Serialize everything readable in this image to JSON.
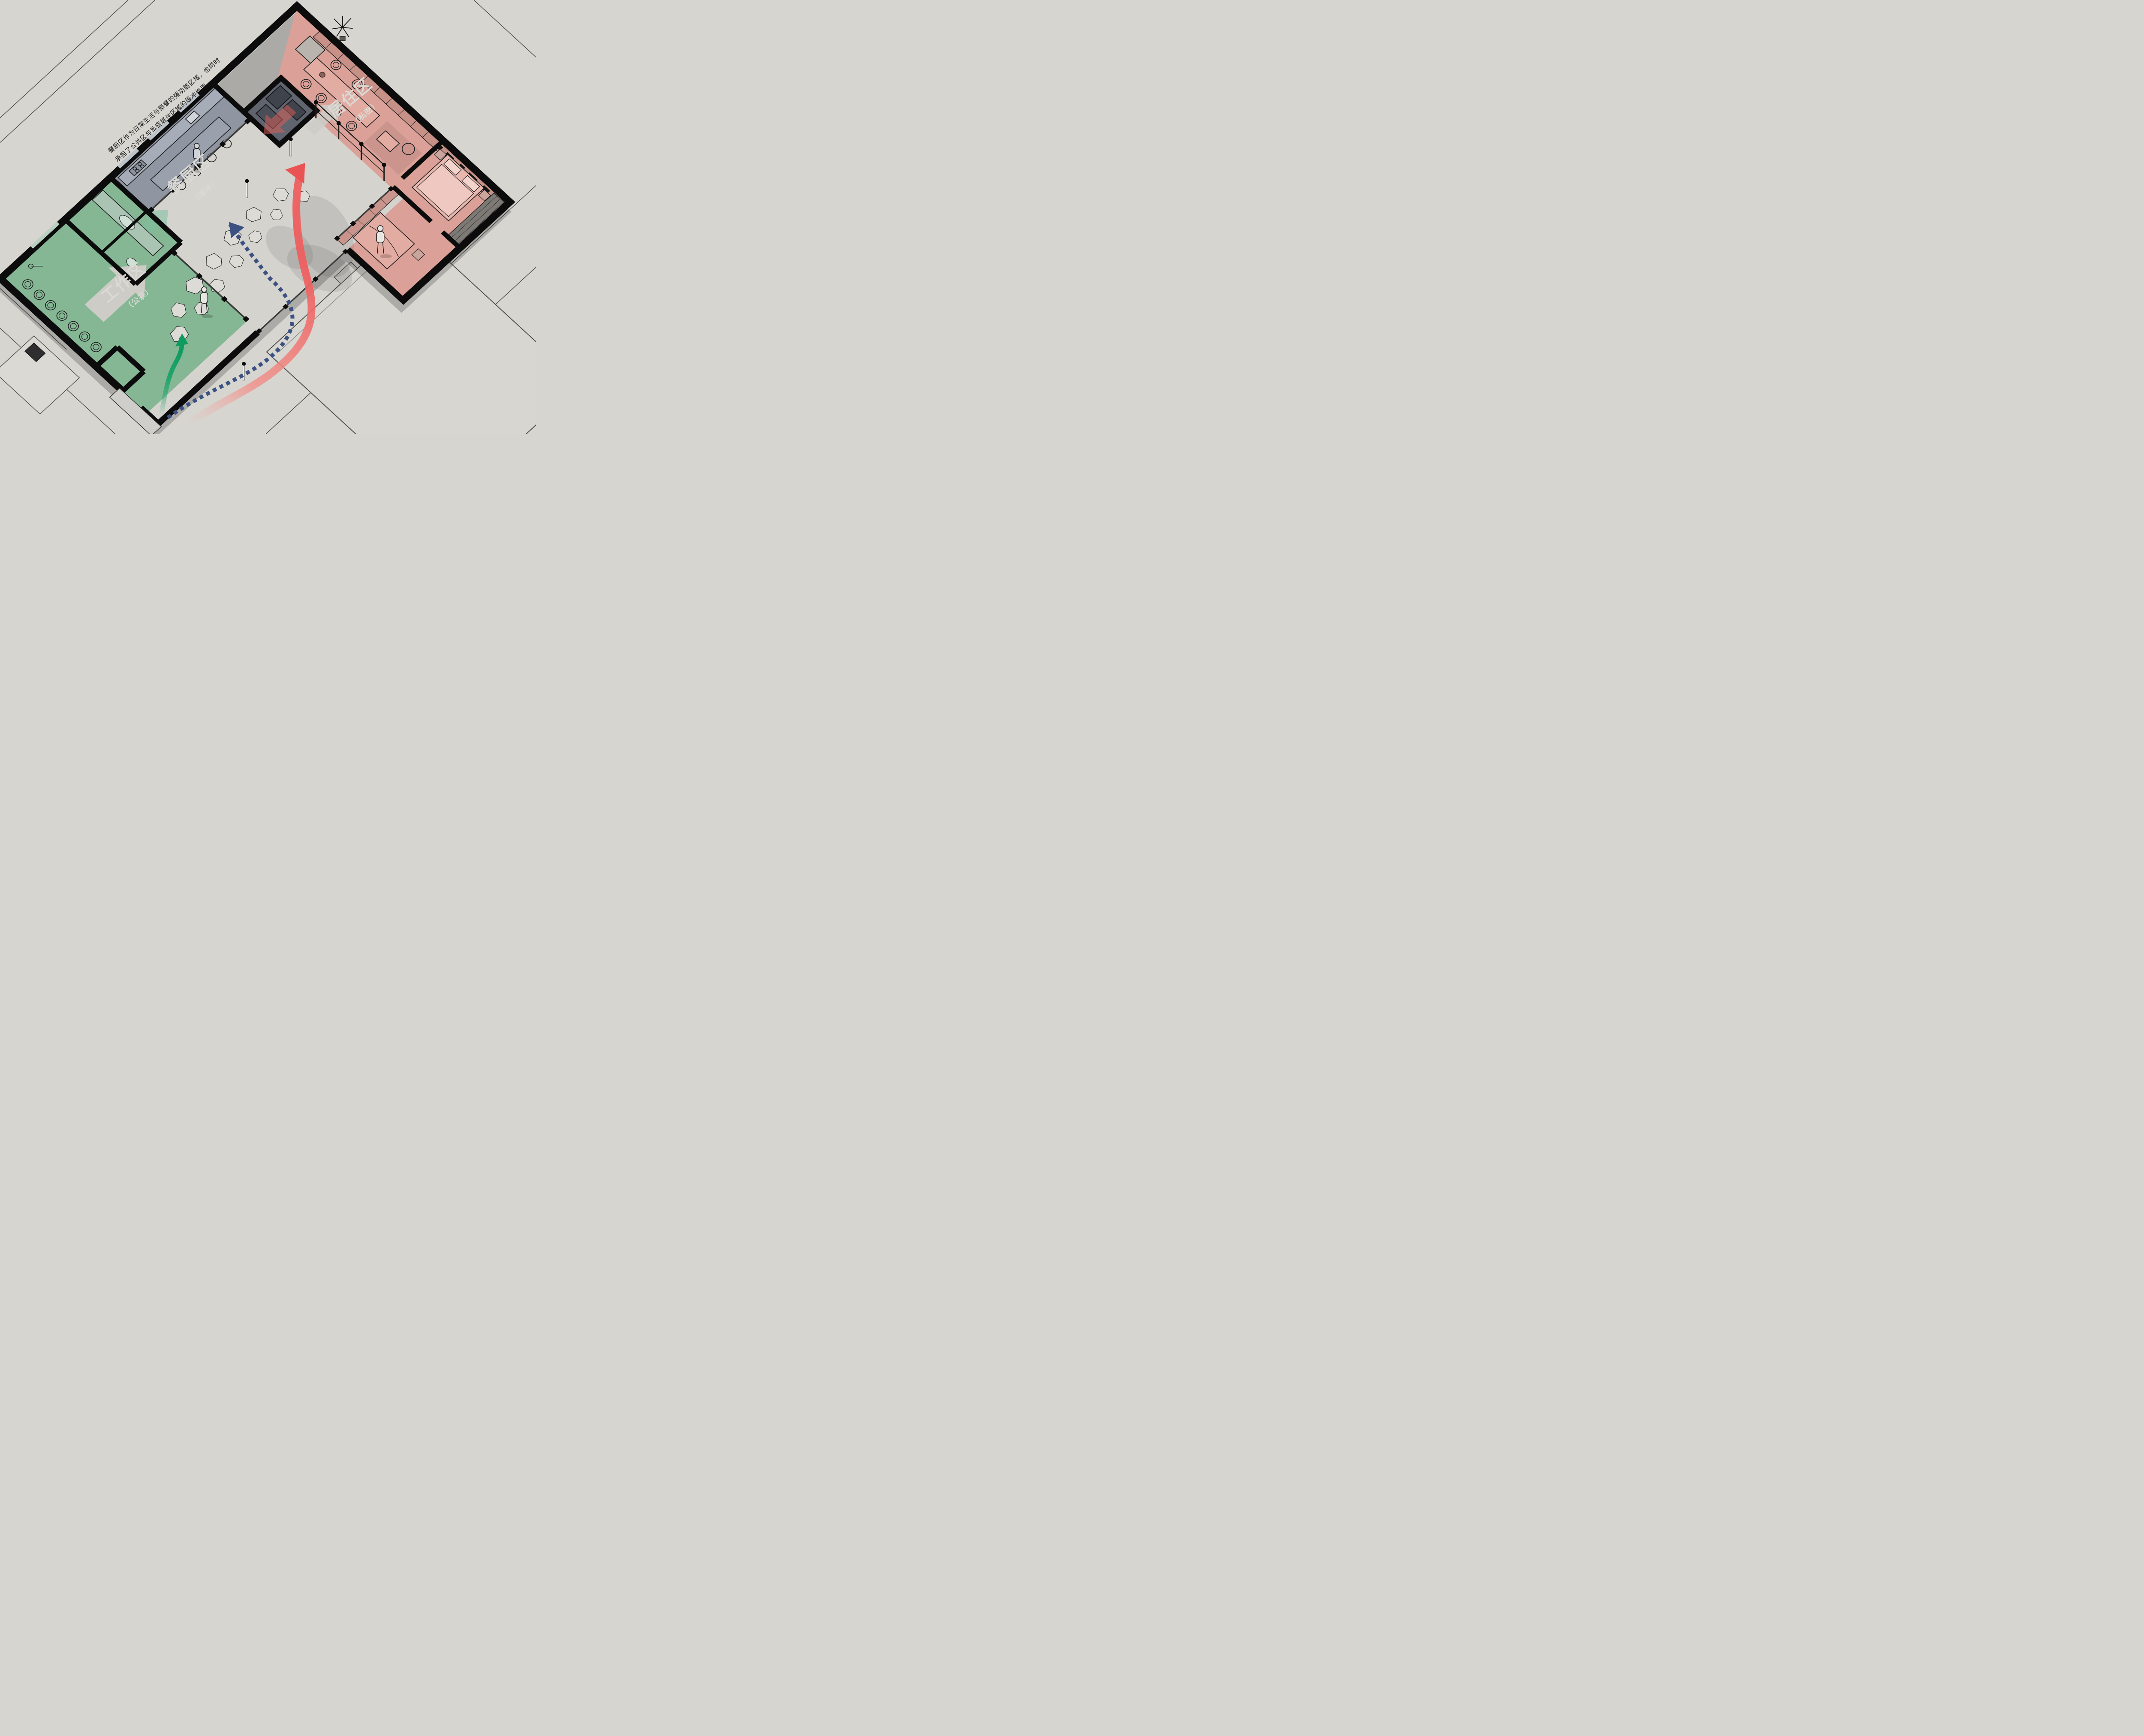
{
  "diagram": {
    "type": "axonometric-floor-plan",
    "annotation": {
      "line1": "餐厨区作为日常生活与聚餐的强功能区域，也同时",
      "line2": "承担了公共区与私密居住区域的缓冲作用。"
    },
    "zones": {
      "dining": {
        "label": "餐厨区",
        "sublabel": "（缓冲）",
        "color": "#8f95a1"
      },
      "living": {
        "label": "居住区",
        "sublabel": "（私密）",
        "color": "#dba198"
      },
      "work": {
        "label": "工作区",
        "sublabel": "（公共）",
        "color": "#85b795"
      }
    },
    "flows": [
      {
        "name": "living-route",
        "style": "solid-ribbon",
        "color": "#ee5f5f",
        "target": "居住区"
      },
      {
        "name": "dining-route",
        "style": "dotted",
        "color": "#3c5181",
        "target": "餐厨区"
      },
      {
        "name": "work-route",
        "style": "solid",
        "color": "#17a266",
        "target": "工作区"
      }
    ],
    "people": [
      {
        "name": "kitchen-person"
      },
      {
        "name": "workspace-person"
      },
      {
        "name": "courtyard-person"
      }
    ],
    "colors": {
      "background": "#d6d5d0",
      "walls": "#0c0c0c",
      "zone_label_text": "#dad9d3",
      "annotation_text": "#161616",
      "block_arrow": "#cdccc6",
      "storage_room": "#5f646e"
    }
  }
}
